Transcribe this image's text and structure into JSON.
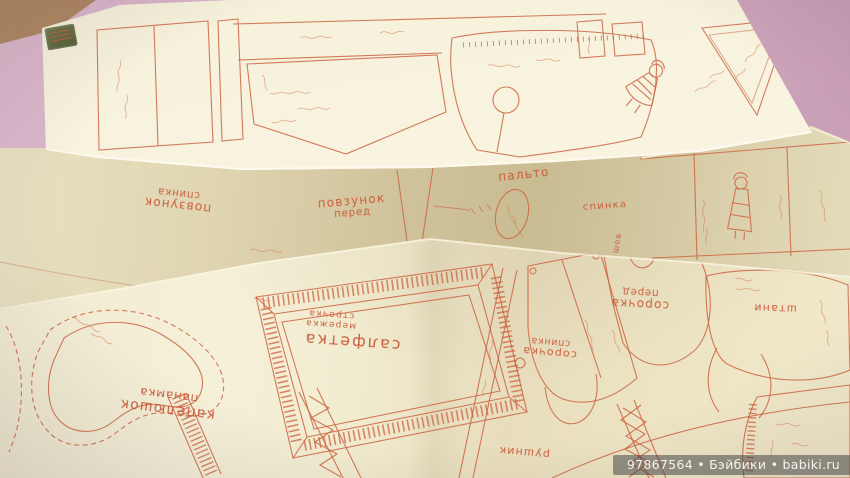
{
  "colors": {
    "ink": "#cd6442",
    "paper_top": "#f7f2dc",
    "paper_middle": "#e2d8b4",
    "paper_bottom": "#f3edd2",
    "background_pink": "#d2aac2",
    "background_wood": "#a3825e",
    "watermark_bg": "rgba(70,70,70,0.55)",
    "watermark_text_color": "#f5f3f0"
  },
  "labels": {
    "middle": {
      "povzunok_spynka_line1": "повзунок",
      "povzunok_spynka_line2": "спинка",
      "povzunok_pered_line1": "повзунок",
      "povzunok_pered_line2": "перед",
      "palto": "пальто",
      "spynka": "спинка",
      "shov": "шов"
    },
    "bottom": {
      "salfetka": "салфетка",
      "merezhka_line1": "мережка",
      "merezhka_line2": "строчка",
      "kapelyushok_line1": "капелюшок",
      "kapelyushok_line2": "панамка",
      "sorochka_spynka_line1": "сорочка",
      "sorochka_spynka_line2": "спинка",
      "sorochka_pered_line1": "сорочка",
      "sorochka_pered_line2": "перед",
      "shtany": "штани",
      "rushnyk": "рушник"
    }
  },
  "watermark": {
    "text": "97867564 • Бэйбики • babiki.ru"
  }
}
